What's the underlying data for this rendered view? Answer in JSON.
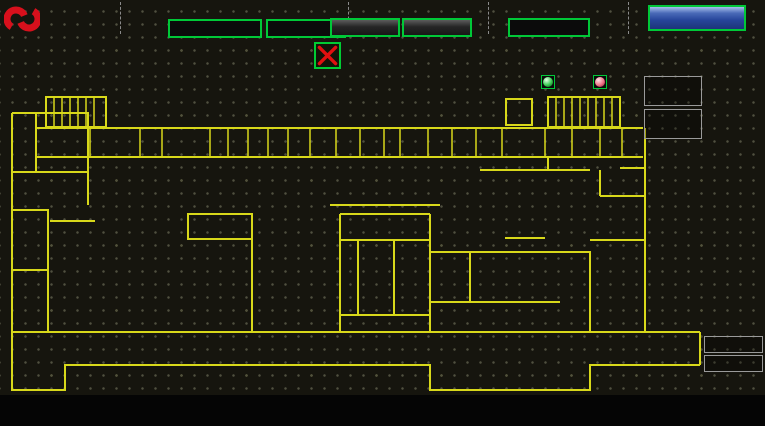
{
  "header": {
    "brand": "宏亞食品",
    "brand_en": "HUNYA FOODS",
    "time_label": "系統時間",
    "date": "2024/12/12",
    "time": "22:09:51",
    "status_label": "冰機 / 空調機 狀態",
    "chiller_status": "系統正常",
    "ahu_status": "系統正常",
    "login_label": "登入人員",
    "login_state": "未登入",
    "login_button": "登入/登出"
  },
  "floor_buttons": [
    [
      "2BC",
      "4BC",
      "2E"
    ],
    [
      "3BC",
      "5BC",
      "3E"
    ],
    [
      "3D",
      "1E"
    ]
  ],
  "legend": {
    "comm_fail": "通信斷線",
    "pv": "PV",
    "sv": "SV",
    "pv_name": "回風",
    "sv_name": "設定",
    "normal": "正常",
    "abnormal": "異常"
  },
  "equipment": {
    "left": [
      {
        "name": "AH-225",
        "pv": "23.5",
        "sv": "23.4"
      }
    ],
    "right": [
      {
        "name": "AH-221A",
        "pv": "23.4",
        "sv": "23.5"
      },
      {
        "name": "SF-221",
        "pv": "23.4",
        "sv": "23.4"
      },
      {
        "name": "EF-221",
        "pv": "23.4",
        "sv": "23.4"
      },
      {
        "name": "AH-218A",
        "pv": "23.4",
        "sv": "23.4"
      },
      {
        "name": "AH-218B",
        "pv": "23.4",
        "sv": "23.4"
      },
      {
        "name": "AH-224",
        "pv": "23.5",
        "sv": "23.4"
      },
      {
        "name": "AH-216",
        "pv": "23.4",
        "sv": "23.4"
      },
      {
        "name": "AH-214",
        "pv": "23.4",
        "sv": "23.4"
      }
    ]
  },
  "floorplan": {
    "units": [
      {
        "id": "AH-215",
        "x": 60,
        "y": 194,
        "label": "送風機\nAH-215",
        "pos": "above"
      },
      {
        "id": "AH-224",
        "x": 219,
        "y": 272,
        "label": "AH-224",
        "pos": "left"
      },
      {
        "id": "AH-218A",
        "x": 355,
        "y": 177,
        "label": "AH-218A",
        "pos": "left"
      },
      {
        "id": "SF-221",
        "x": 403,
        "y": 178,
        "label": "SF-221",
        "pos": "below"
      },
      {
        "id": "AH-216",
        "x": 329,
        "y": 276,
        "label": "AH-216",
        "pos": "above"
      },
      {
        "id": "EF-221",
        "x": 411,
        "y": 275,
        "label": "EF-221",
        "pos": "above"
      },
      {
        "id": "AH-225",
        "x": 555,
        "y": 273,
        "label": "AH-225",
        "pos": "above"
      },
      {
        "id": "AH-214",
        "x": 555,
        "y": 143,
        "label": "AH-214",
        "pos": "right"
      },
      {
        "id": "AH-218B",
        "x": 634,
        "y": 141,
        "label": "冰水機\nAH-218B",
        "pos": "left"
      },
      {
        "id": "AH-221A",
        "x": 511,
        "y": 211,
        "label": "AH-221A",
        "pos": "above"
      }
    ],
    "rooms": [
      {
        "x": 98,
        "y": 131,
        "text": "工具\n機房"
      },
      {
        "x": 152,
        "y": 139,
        "text": "自動倉儲區"
      },
      {
        "x": 228,
        "y": 127,
        "text": "電梯間",
        "v": true
      },
      {
        "x": 247,
        "y": 127,
        "text": "樓梯間",
        "v": true
      },
      {
        "x": 481,
        "y": 136,
        "text": "AH-B3"
      },
      {
        "x": 499,
        "y": 149,
        "text": "餅乾調理室"
      },
      {
        "x": 543,
        "y": 169,
        "text": "調理室"
      },
      {
        "x": 640,
        "y": 169,
        "text": "冰水機"
      },
      {
        "x": 48,
        "y": 238,
        "text": "冰水\n主機"
      },
      {
        "x": 193,
        "y": 221,
        "text": "機械工具間"
      },
      {
        "x": 360,
        "y": 220,
        "text": "調料室"
      },
      {
        "x": 362,
        "y": 271,
        "text": "更衣室"
      },
      {
        "x": 68,
        "y": 314,
        "text": "配電室"
      },
      {
        "x": 339,
        "y": 343,
        "text": "烘"
      },
      {
        "x": 386,
        "y": 343,
        "text": "廁"
      },
      {
        "x": 666,
        "y": 322,
        "text": "廁"
      }
    ],
    "elevators": [
      {
        "x": 76,
        "y": 342,
        "cells": 2
      },
      {
        "x": 308,
        "y": 338,
        "cells": 2
      },
      {
        "x": 406,
        "y": 338,
        "cells": 1
      },
      {
        "x": 646,
        "y": 336,
        "cells": 2
      },
      {
        "x": 341,
        "y": 130,
        "cells": 1,
        "small": true
      },
      {
        "x": 381,
        "y": 130,
        "cells": 1,
        "small": true
      },
      {
        "x": 50,
        "y": 130,
        "cells": 1,
        "small": true
      }
    ]
  },
  "footer": {
    "buttons": [
      "空調系統",
      "空調箱系統",
      "參數設定",
      "儀表監視",
      "密碼權限",
      "異常警報"
    ]
  },
  "colors": {
    "wall": "#d8d81a",
    "magenta": "#ff2bff",
    "green_border": "#00c838",
    "pv_red": "#ff2a2a",
    "sv_green": "#29e24a",
    "button_blue": "#27459a"
  }
}
